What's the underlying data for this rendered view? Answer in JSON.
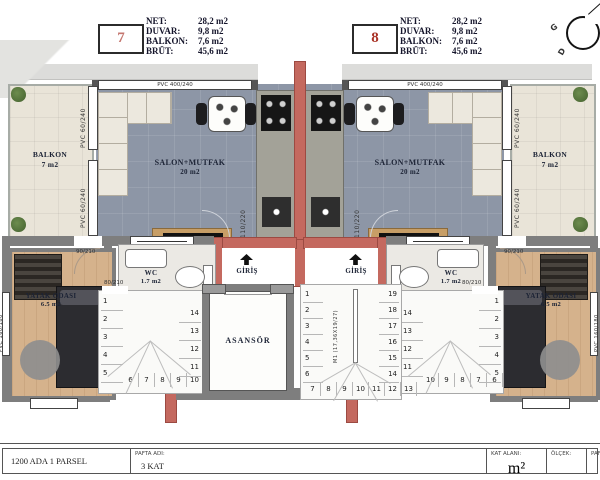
{
  "legend": {
    "unit7": {
      "number": "7",
      "labels": [
        "NET:",
        "DUVAR:",
        "BALKON:",
        "BRÜT:"
      ],
      "values": [
        "28,2 m2",
        "9,8 m2",
        "7,6 m2",
        "45,6 m2"
      ]
    },
    "unit8": {
      "number": "8",
      "labels": [
        "NET:",
        "DUVAR:",
        "BALKON:",
        "BRÜT:"
      ],
      "values": [
        "28,2 m2",
        "9,8 m2",
        "7,6 m2",
        "45,6 m2"
      ]
    }
  },
  "compass": {
    "west": "G",
    "south": "D"
  },
  "rooms": {
    "left": {
      "balkon": {
        "name": "BALKON",
        "area": "7 m2"
      },
      "salon": {
        "name": "SALON+MUTFAK",
        "area": "20 m2"
      },
      "wc": {
        "name": "WC",
        "area": "1.7 m2"
      },
      "giris": {
        "name": "GİRİŞ"
      },
      "yatak": {
        "name": "YATAK ODASI",
        "area": "6.5 m2"
      }
    },
    "right": {
      "balkon": {
        "name": "BALKON",
        "area": "7 m2"
      },
      "salon": {
        "name": "SALON+MUTFAK",
        "area": "20 m2"
      },
      "wc": {
        "name": "WC",
        "area": "1.7 m2"
      },
      "giris": {
        "name": "GİRİŞ"
      },
      "yatak": {
        "name": "YATAK ODASI",
        "area": "6.5 m2"
      }
    },
    "asansor": {
      "name": "ASANSÖR"
    }
  },
  "annotations": {
    "window_top": "PVC 400/240",
    "balkon_window": "PVC 60/240",
    "bedroom_window": "PVC 160/180",
    "salon_door": "110/220",
    "bedroom_door": "90/210",
    "stair_door": "80/210",
    "stair_note": "M1 (17,36X19/27)"
  },
  "stairs": {
    "unit_left": {
      "col_left": [
        "1",
        "2",
        "3",
        "4",
        "5"
      ],
      "row_bottom": [
        "6",
        "7",
        "8",
        "9",
        "10"
      ],
      "col_right": [
        "14",
        "13",
        "12",
        "11"
      ]
    },
    "unit_right": {
      "col_left": [
        "14",
        "13",
        "12",
        "11"
      ],
      "row_bottom": [
        "10",
        "9",
        "8",
        "7",
        "6"
      ],
      "col_right": [
        "1",
        "2",
        "3",
        "4",
        "5"
      ]
    },
    "central": {
      "col_left": [
        "1",
        "2",
        "3",
        "4",
        "5",
        "6"
      ],
      "row_bottom": [
        "7",
        "8",
        "9",
        "10",
        "11",
        "12",
        "13"
      ],
      "col_right": [
        "19",
        "18",
        "17",
        "16",
        "15",
        "14"
      ]
    }
  },
  "titleblock": {
    "parcel": "1200 ADA 1 PARSEL",
    "pafta_label": "PAFTA ADI:",
    "pafta_value": "3 KAT",
    "kat_alani_label": "KAT ALANI:",
    "kat_alani_value": "m²",
    "olcek_label": "ÖLÇEK:",
    "paf_label": "PAF"
  },
  "colors": {
    "wall_red": "#c4695f",
    "wall_gray": "#7e7e7e",
    "salon_floor": "#8d96a6",
    "balkon_floor": "#e9e4d8",
    "wood_floor": "#d5b28c"
  }
}
